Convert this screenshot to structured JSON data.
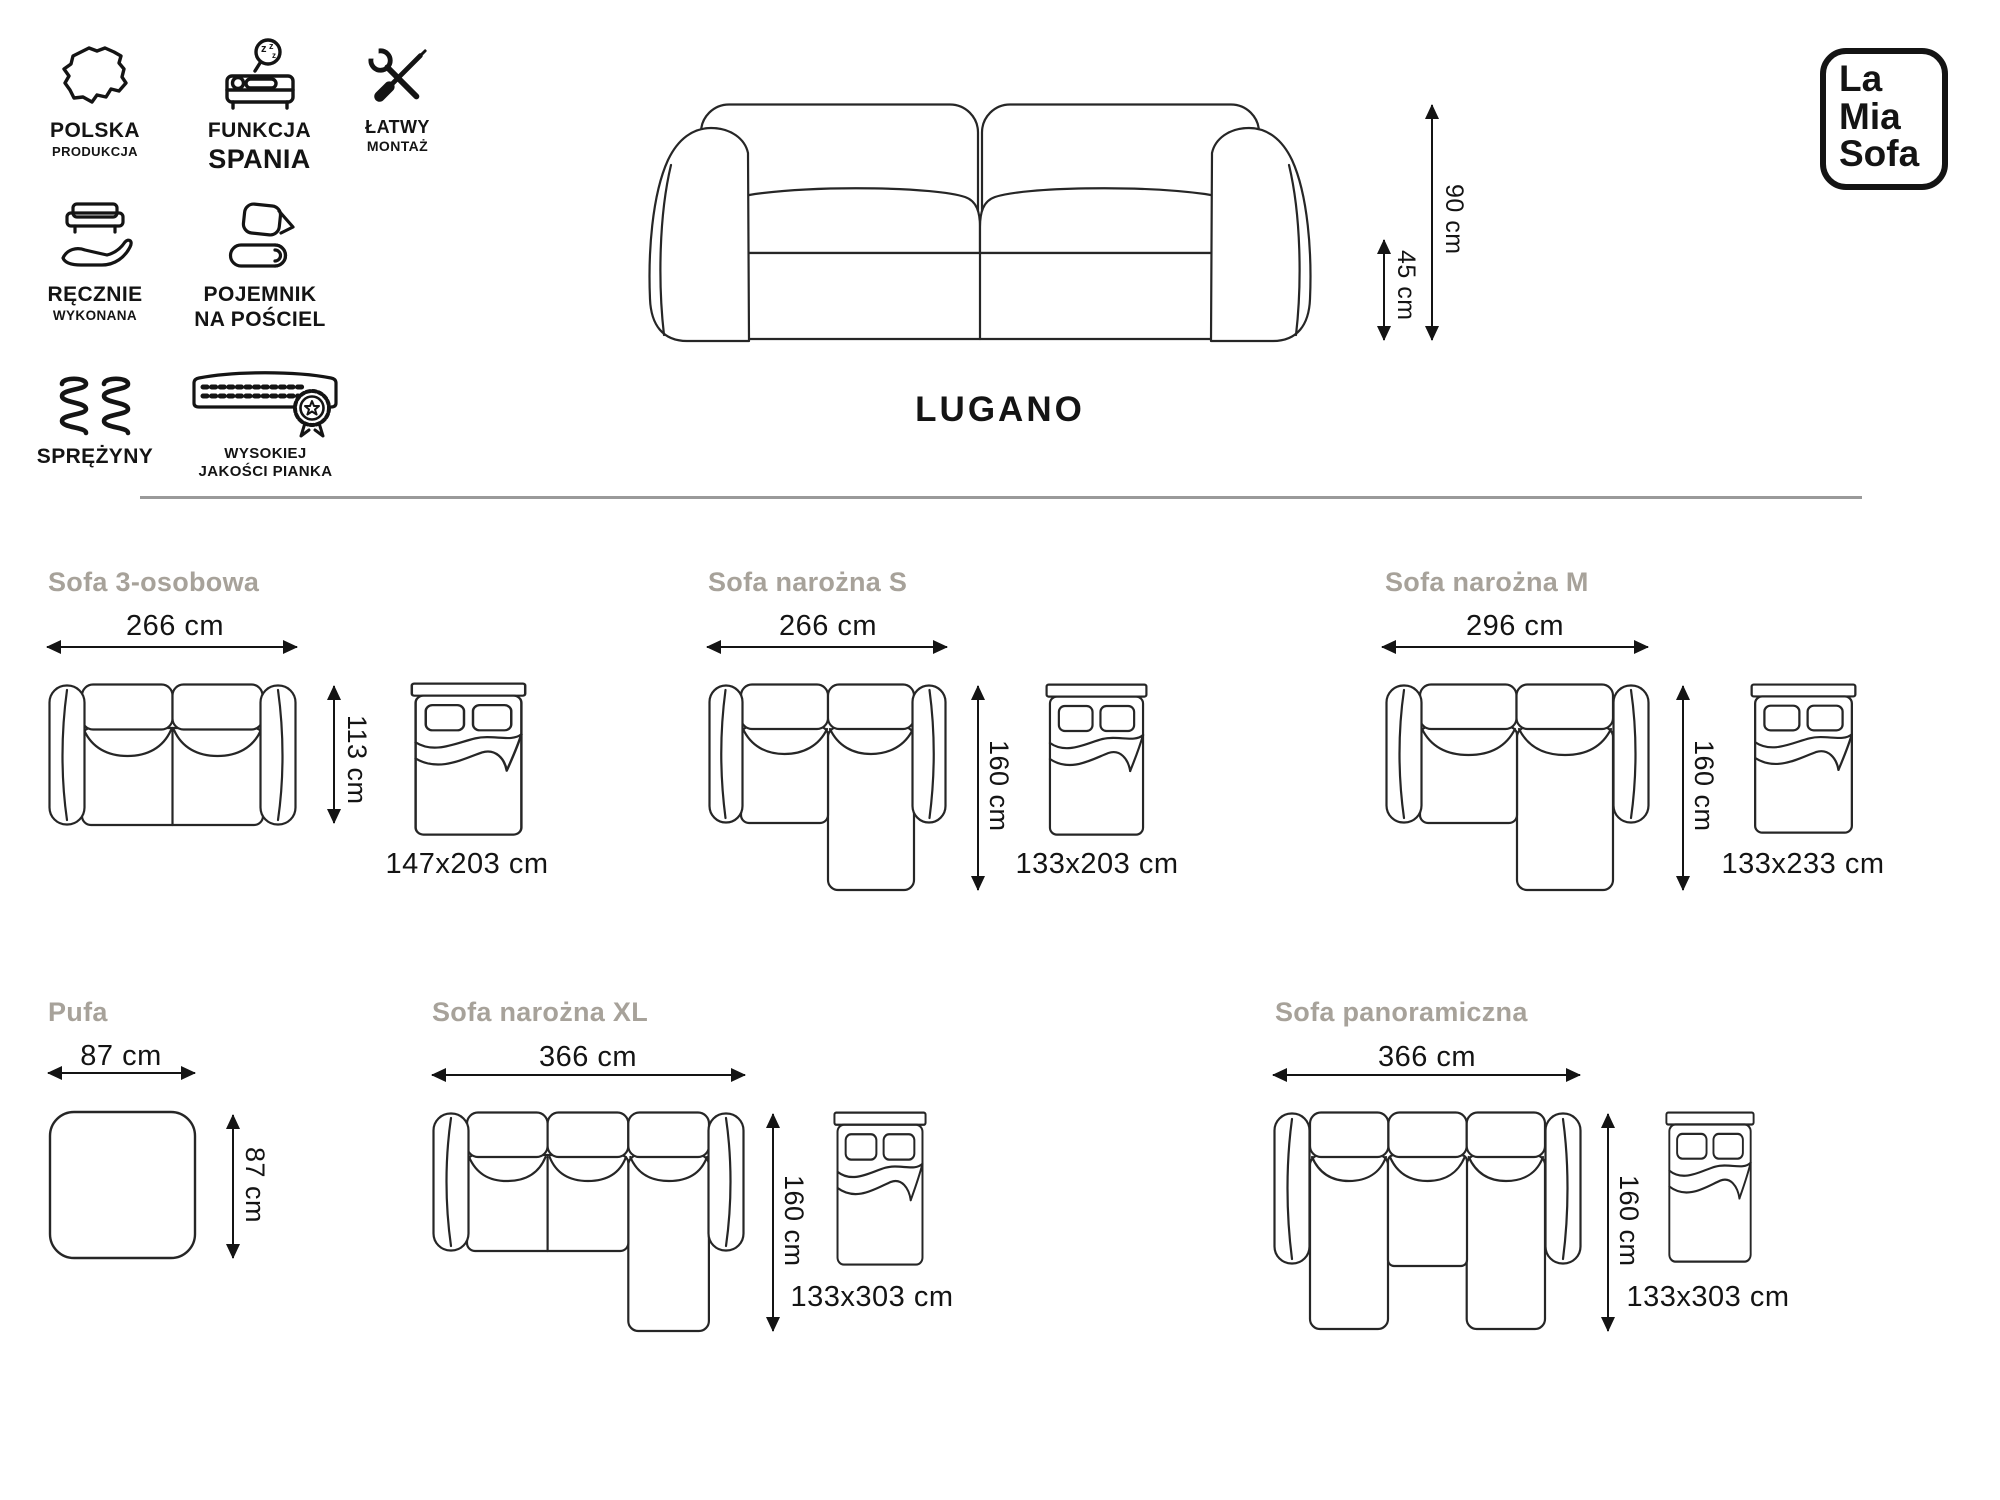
{
  "brand": {
    "logo_lines": [
      "La",
      "Mia",
      "Sofa"
    ]
  },
  "hero": {
    "model_name": "LUGANO",
    "height": "90 cm",
    "seat_height": "45 cm"
  },
  "features": [
    {
      "name": "polska-produkcja",
      "icon": "poland-map",
      "lines": [
        "POLSKA",
        "PRODUKCJA"
      ]
    },
    {
      "name": "funkcja-spania",
      "icon": "sleeping-person-sofa",
      "lines": [
        "FUNKCJA",
        "SPANIA"
      ]
    },
    {
      "name": "latwy-montaz",
      "icon": "wrench-screwdriver",
      "lines": [
        "ŁATWY",
        "MONTAŻ"
      ]
    },
    {
      "name": "recznie-wykonana",
      "icon": "sofa-on-hand",
      "lines": [
        "RĘCZNIE",
        "WYKONANA"
      ]
    },
    {
      "name": "pojemnik-na-posciel",
      "icon": "bedding-storage",
      "lines": [
        "POJEMNIK",
        "NA POŚCIEL"
      ]
    },
    {
      "name": "sprezyny",
      "icon": "springs",
      "lines": [
        "SPRĘŻYNY",
        ""
      ]
    },
    {
      "name": "wysokiej-jakosci-pianka",
      "icon": "foam-mattress-badge",
      "lines": [
        "WYSOKIEJ",
        "JAKOŚCI PIANKA"
      ]
    }
  ],
  "variants": [
    {
      "title": "Sofa 3-osobowa",
      "width": "266 cm",
      "depth": "113 cm",
      "bed": "147x203 cm"
    },
    {
      "title": "Sofa narożna S",
      "width": "266 cm",
      "depth": "160 cm",
      "bed": "133x203 cm"
    },
    {
      "title": "Sofa narożna M",
      "width": "296 cm",
      "depth": "160 cm",
      "bed": "133x233 cm"
    },
    {
      "title": "Pufa",
      "width": "87 cm",
      "depth": "87 cm",
      "bed": ""
    },
    {
      "title": "Sofa narożna XL",
      "width": "366 cm",
      "depth": "160 cm",
      "bed": "133x303 cm"
    },
    {
      "title": "Sofa panoramiczna",
      "width": "366 cm",
      "depth": "160 cm",
      "bed": "133x303 cm"
    }
  ],
  "colors": {
    "ink": "#141414",
    "line": "#262626",
    "muted_title": "#a7a29a",
    "divider": "#9a9a9a",
    "background": "#ffffff"
  }
}
